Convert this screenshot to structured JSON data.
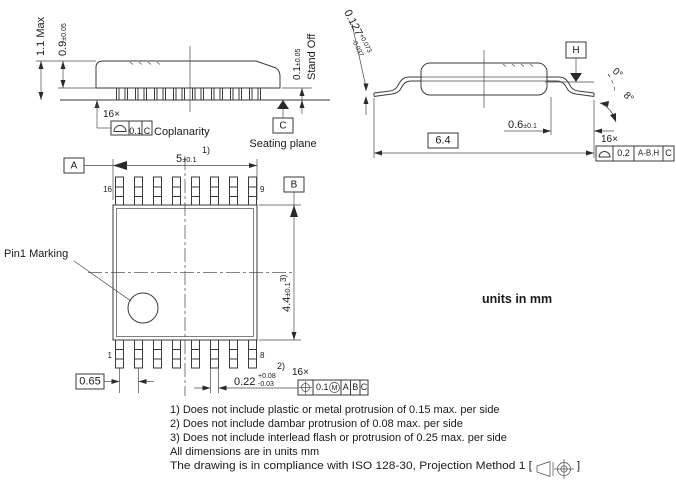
{
  "units_label": "units in mm",
  "side_view": {
    "height_max": "1.1 Max",
    "body_thickness_val": "0.9",
    "body_thickness_tol": "±0.05",
    "standoff_val": "0.1",
    "standoff_tol": "±0.05",
    "standoff_label": "Stand Off",
    "lead_count": "16×",
    "coplanarity": {
      "tol": "0.1",
      "datum": "C",
      "label": "Coplanarity"
    },
    "seating": {
      "datum": "C",
      "label": "Seating plane"
    }
  },
  "end_view": {
    "lead_thickness_val": "0.127",
    "lead_thickness_plus": "+0.073",
    "lead_thickness_minus": "-0.037",
    "datum_h": "H",
    "angle_min": "0°",
    "angle_max": "8°",
    "foot_val": "0.6",
    "foot_tol": "±0.1",
    "span": "6.4",
    "lead_count": "16×",
    "profile_fcf": {
      "tol": "0.2",
      "datums_primary": "A-B,H",
      "datum_secondary": "C"
    }
  },
  "top_view": {
    "datum_a": "A",
    "datum_b": "B",
    "width_val": "5",
    "width_tol": "±0.1",
    "width_note": "1)",
    "length_val": "4.4",
    "length_tol": "±0.1",
    "length_note": "3)",
    "pins": {
      "p16": "16",
      "p9": "9",
      "p1": "1",
      "p8": "8"
    },
    "pin1_label": "Pin1 Marking",
    "pitch": "0.65",
    "lead_width_val": "0.22",
    "lead_width_plus": "+0.08",
    "lead_width_minus": "-0.03",
    "lead_width_note": "2)",
    "lead_count": "16×",
    "position_fcf": {
      "tol": "0.1",
      "modifier": "M",
      "datum_a": "A",
      "datum_b": "B",
      "datum_c": "C"
    }
  },
  "notes": {
    "n1": "1) Does not include plastic or metal protrusion of 0.15 max. per side",
    "n2": "2) Does not include dambar protrusion of 0.08 max. per side",
    "n3": "3) Does not include interlead flash or protrusion of 0.25 max. per side",
    "n4": "All dimensions are in units mm",
    "n5_prefix": "The drawing is in compliance with ISO 128-30, Projection Method 1 [",
    "n5_suffix": "]"
  }
}
